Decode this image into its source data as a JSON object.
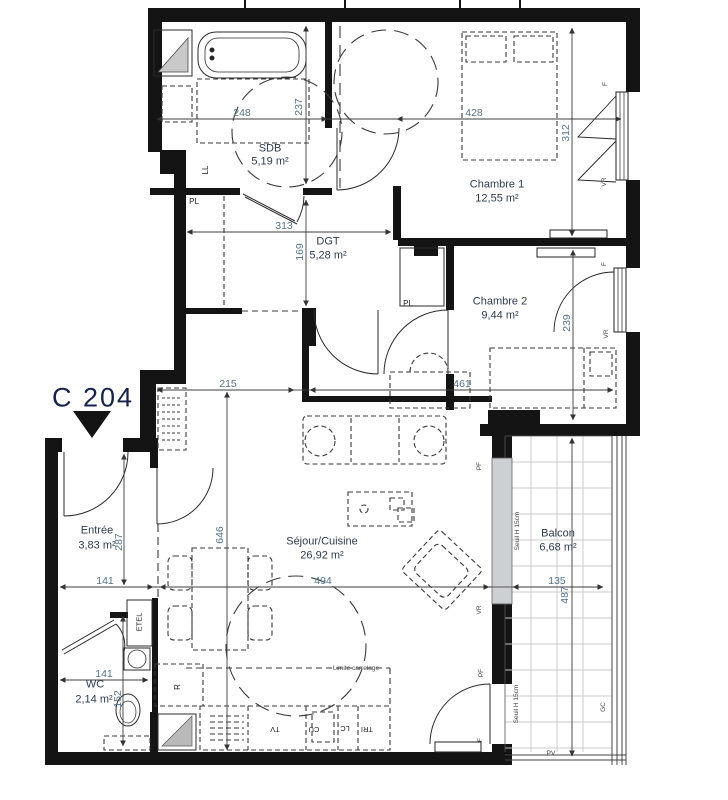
{
  "title": {
    "label": "C 204"
  },
  "rooms": {
    "sdb": {
      "name": "SDB",
      "area": "5,19 m²"
    },
    "chambre1": {
      "name": "Chambre 1",
      "area": "12,55 m²"
    },
    "chambre2": {
      "name": "Chambre 2",
      "area": "9,44 m²"
    },
    "dgt": {
      "name": "DGT",
      "area": "5,28 m²"
    },
    "entree": {
      "name": "Entrée",
      "area": "3,83 m²"
    },
    "wc": {
      "name": "WC",
      "area": "2,14 m²"
    },
    "sejour": {
      "name": "Séjour/Cuisine",
      "area": "26,92 m²"
    },
    "balcon": {
      "name": "Balcon",
      "area": "6,68 m²"
    }
  },
  "dimensions": {
    "sdb_width": "248",
    "sdb_depth": "237",
    "ch1_width": "428",
    "ch1_depth": "312",
    "dgt_width": "313",
    "dgt_depth": "169",
    "hall_left": "215",
    "ch2_width": "461",
    "ch2_depth": "239",
    "entree_depth": "287",
    "entree_width": "141",
    "sejour_depth": "646",
    "sejour_width": "494",
    "balcon_width": "135",
    "balcon_depth": "487",
    "wc_width": "141",
    "wc_depth": "152"
  },
  "annotations": {
    "ll": "LL",
    "pl_sdb": "PL",
    "pl_dgt": "PL",
    "etel": "ETEL",
    "fridge": "R",
    "tv": "TV",
    "cu": "CU",
    "lc": "LC",
    "tri": "TRI",
    "limite_carrelage": "Limite carrelage",
    "seuil_1": "Seuil H 15cm",
    "seuil_2": "Seuil H 15cm",
    "pv": "PV",
    "gc": "GC",
    "window_f_1": "F",
    "window_vr_1": "VR",
    "window_f_2": "F",
    "window_vr_2": "VR",
    "door_pf_1": "PF",
    "window_vr_3": "VR",
    "door_pf_2": "PF",
    "window_f_3": "F"
  },
  "colors": {
    "wall": "#141414",
    "dim_text": "#54728c",
    "room_text": "#2e3b4e",
    "title_text": "#15224b",
    "balcony_grid": "#c9c9c9"
  }
}
